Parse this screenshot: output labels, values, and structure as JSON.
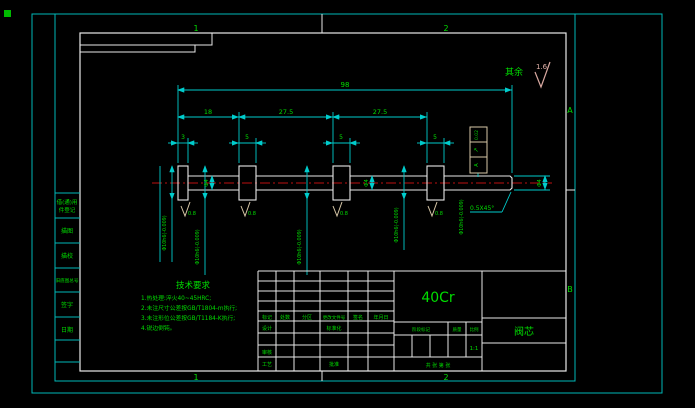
{
  "drawing": {
    "surface_default": {
      "prefix": "其余",
      "roughness": "1.6"
    },
    "zones": {
      "t1": "1",
      "t2": "2",
      "b1": "1",
      "b2": "2",
      "rA": "A",
      "rB": "B"
    },
    "dims": {
      "overall": "98",
      "d18": "18",
      "d275a": "27.5",
      "d275b": "27.5",
      "d3": "3",
      "d5a": "5",
      "d5b": "5",
      "d5c": "5",
      "dia4": "Φ4",
      "dia10": "Φ10h6(-0.009)",
      "chamfer": "0.5X45°",
      "roughness": "0.8",
      "fcf_tol": "0.02",
      "fcf_sym": "↗",
      "fcf_datum": "A"
    }
  },
  "tech_req": {
    "title": "技术要求",
    "line1": "1.热处理:淬火40~45HRC;",
    "line2": "2.未注尺寸公差按GB/T1804-m执行;",
    "line3": "3.未注形位公差按GB/T1184-K执行;",
    "line4": "4.锐边倒钝。"
  },
  "margin": {
    "r1a": "借(通)用",
    "r1b": "件登记",
    "r2": "描图",
    "r3": "描校",
    "r4": "旧底图总号",
    "r5": "签字",
    "r6": "日期"
  },
  "title_block": {
    "material": "40Cr",
    "part_name": "阀芯",
    "h_mark": "标记",
    "h_count": "处数",
    "h_zone": "分区",
    "h_file": "更改文件号",
    "h_sign": "签名",
    "h_date": "年月日",
    "design": "设计",
    "standard": "标准化",
    "check": "审核",
    "process": "工艺",
    "approve": "批准",
    "stage": "阶段标记",
    "weight": "质量",
    "scale": "比例",
    "scale_value": "1:1",
    "sheets": "共 张 第 张"
  }
}
